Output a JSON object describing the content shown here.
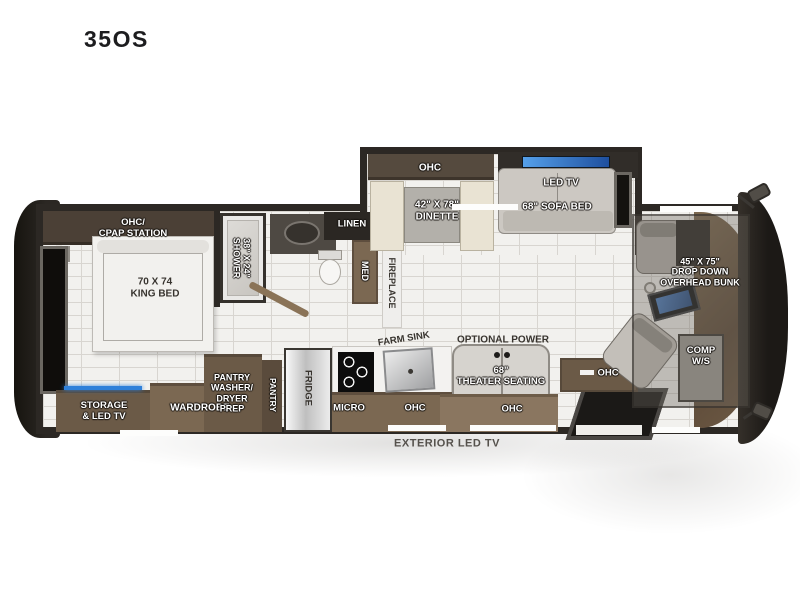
{
  "title": "35OS",
  "colors": {
    "led_blue": "#3d82da",
    "wood_brown": "#7b6852",
    "dark_wall": "#2c2824",
    "floor_tile": "#f2f1ee",
    "seat_gray": "#d6d3ce"
  },
  "labels": {
    "bedroom": {
      "ohc_cpap": "OHC/\nCPAP STATION",
      "king_bed": "70 X 74\nKING BED",
      "storage_led_tv": "STORAGE\n& LED TV",
      "wardrobe": "WARDROBE"
    },
    "bath": {
      "shower": "38\" X 24\"\nSHOWER",
      "linen": "LINEN",
      "med": "MED",
      "fireplace": "FIREPLACE"
    },
    "kitchen": {
      "pantry_wd_prep": "PANTRY\nWASHER/\nDRYER\nPREP",
      "pantry": "PANTRY",
      "fridge": "FRIDGE",
      "micro": "MICRO",
      "farm_sink": "FARM SINK",
      "ohc": "OHC"
    },
    "slide": {
      "ohc": "OHC",
      "dinette": "42\" X 78\"\nDINETTE",
      "led_tv": "LED TV",
      "sofa_bed": "68\" SOFA BED"
    },
    "living": {
      "optional_power": "OPTIONAL POWER",
      "theater_seating": "68\"\nTHEATER SEATING",
      "ohc_theater": "OHC",
      "ohc_door": "OHC"
    },
    "cab": {
      "overhead_bunk": "45\" X 75\"\nDROP DOWN\nOVERHEAD BUNK",
      "comp_ws": "COMP\nW/S"
    },
    "exterior": {
      "led_tv": "EXTERIOR LED TV"
    }
  }
}
